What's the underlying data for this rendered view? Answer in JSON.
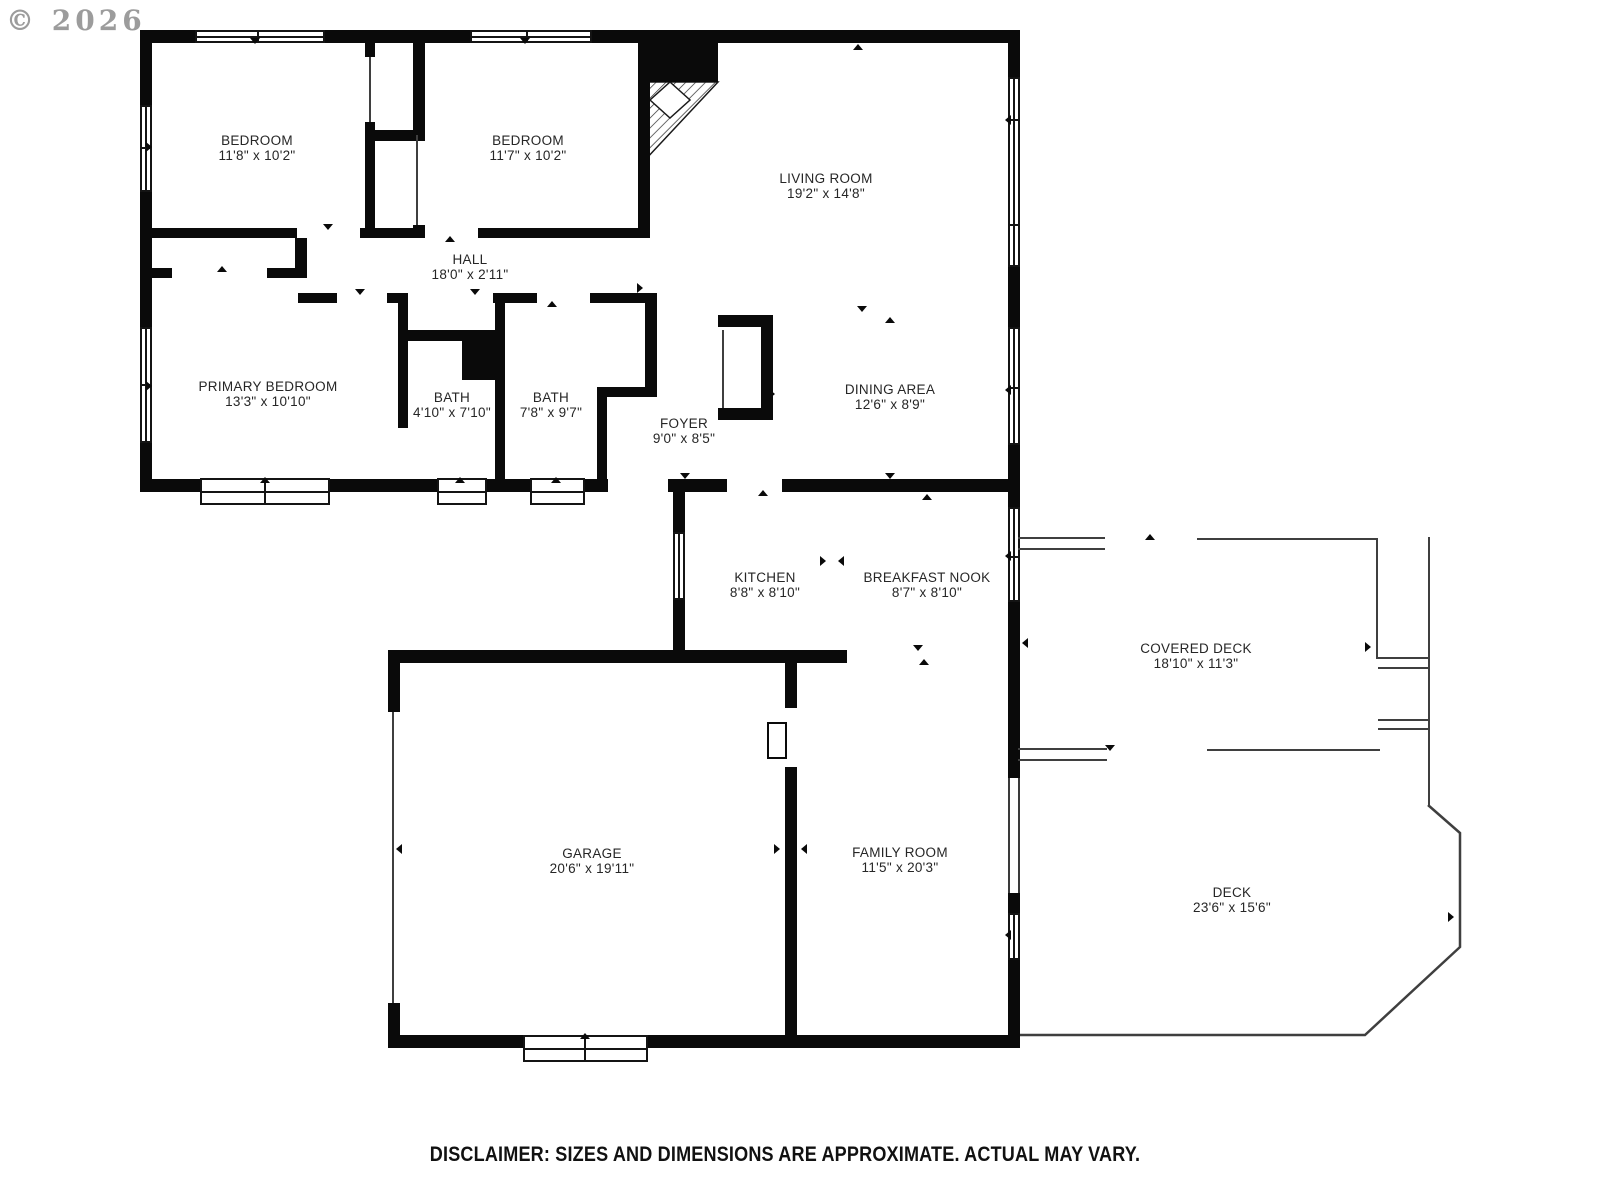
{
  "watermark": {
    "symbol": "©",
    "year": "2026"
  },
  "rooms": {
    "bedroom1": {
      "name": "BEDROOM",
      "dims": "11'8\" x 10'2\""
    },
    "bedroom2": {
      "name": "BEDROOM",
      "dims": "11'7\" x 10'2\""
    },
    "living_room": {
      "name": "LIVING ROOM",
      "dims": "19'2\" x 14'8\""
    },
    "hall": {
      "name": "HALL",
      "dims": "18'0\" x 2'11\""
    },
    "primary_bedroom": {
      "name": "PRIMARY BEDROOM",
      "dims": "13'3\" x 10'10\""
    },
    "bath1": {
      "name": "BATH",
      "dims": "4'10\" x 7'10\""
    },
    "bath2": {
      "name": "BATH",
      "dims": "7'8\" x 9'7\""
    },
    "foyer": {
      "name": "FOYER",
      "dims": "9'0\" x 8'5\""
    },
    "dining_area": {
      "name": "DINING AREA",
      "dims": "12'6\" x 8'9\""
    },
    "kitchen": {
      "name": "KITCHEN",
      "dims": "8'8\" x 8'10\""
    },
    "breakfast_nook": {
      "name": "BREAKFAST NOOK",
      "dims": "8'7\" x 8'10\""
    },
    "covered_deck": {
      "name": "COVERED DECK",
      "dims": "18'10\" x 11'3\""
    },
    "garage": {
      "name": "GARAGE",
      "dims": "20'6\" x 19'11\""
    },
    "family_room": {
      "name": "FAMILY ROOM",
      "dims": "11'5\" x 20'3\""
    },
    "deck": {
      "name": "DECK",
      "dims": "23'6\" x 15'6\""
    }
  },
  "disclaimer": "DISCLAIMER: SIZES AND DIMENSIONS ARE APPROXIMATE. ACTUAL MAY VARY.",
  "colors": {
    "wall": "#0a0a0a",
    "thin_line": "#3f3f3f",
    "watermark": "#9c9c9c",
    "text": "#262626",
    "background": "#ffffff"
  }
}
